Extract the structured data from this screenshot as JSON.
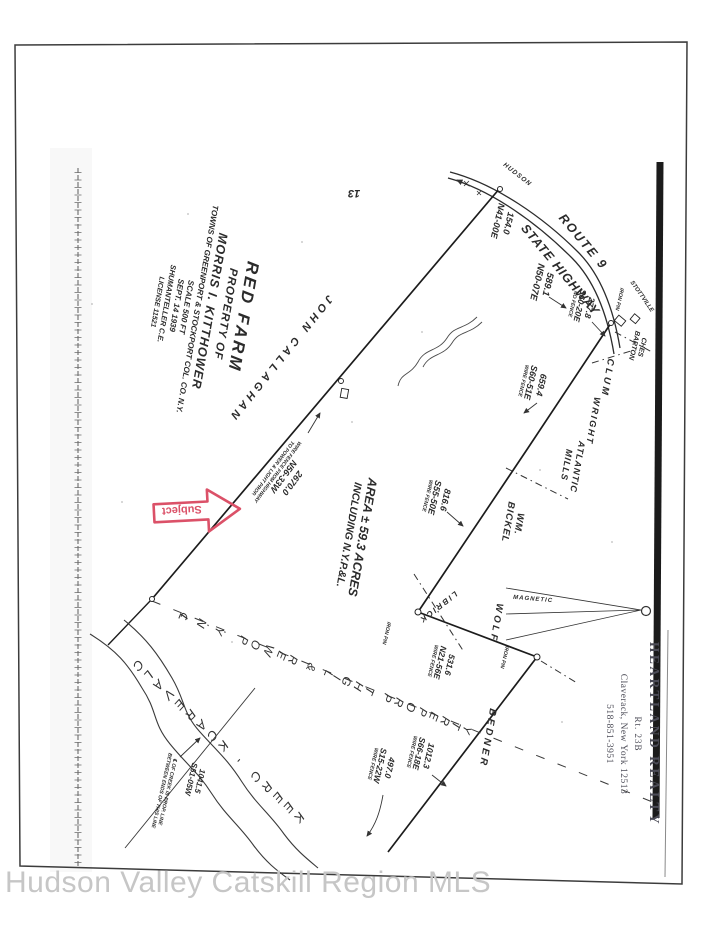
{
  "colors": {
    "ink": "#2b2b2b",
    "stamp_red": "#db5168",
    "watermark_gray": "#c6c6c6"
  },
  "watermark": "Hudson Valley Catskill Region MLS",
  "sheet_number": "13",
  "title_block": {
    "line1": "RED FARM",
    "line2": "PROPERTY OF",
    "line3": "MORRIS I. KITTHOWER",
    "line4": "TOWNS OF GREENPORT & STOCKPORT COL. CO. N.Y.",
    "line5": "SCALE 500 FT",
    "line6": "SEPT. 14 1939",
    "line7": "SHUMANTELLER C.E.",
    "line8": "LICENSE 11521"
  },
  "road": {
    "name1": "ROUTE 9",
    "name2": "STATE HIGHWAY",
    "dir_north": "HUDSON",
    "dir_south": "STOTTVILLE"
  },
  "area": {
    "line1": "AREA ± 59.3 ACRES",
    "line2": "INCLUDING N.Y.P.&L."
  },
  "neighbors": {
    "callaghan": "JOHN CALLAGHAN",
    "ches_barton1": "CHES",
    "ches_barton2": "BARTON",
    "clum": "CLUM",
    "wright": "WRIGHT",
    "atlantic1": "ATLANTIC",
    "atlantic2": "MILLS",
    "bickel1": "WM.",
    "bickel2": "BICKEL",
    "wolf": "WOLF",
    "librick": "LIBRICK",
    "bedner": "BEDNER"
  },
  "bearings": {
    "b154": {
      "dist": "154.0",
      "bear": "N41-00E"
    },
    "b589": {
      "dist": "589.1",
      "bear": "N50-07E"
    },
    "b277": {
      "dist": "277.8",
      "bear": "S60-20E",
      "note": "NO FENCE"
    },
    "b659": {
      "dist": "659.4",
      "bear": "S60-51E",
      "note": "WIRE FENCE"
    },
    "b816": {
      "dist": "816.6",
      "bear": "S55-50E",
      "note": "WIRE FENCE"
    },
    "b2670": {
      "dist": "2670.0",
      "bear": "N56-33W",
      "note1": "WIRE FENCE FROM HIGHWAY",
      "note2": "TO POWER & LIGHT PROP."
    },
    "b531": {
      "dist": "531.6",
      "bear": "N21-56E",
      "note": "WIRE FENCE"
    },
    "b1012": {
      "dist": "1012.3",
      "bear": "S66-18E",
      "note": "WIRE FENCE"
    },
    "b497": {
      "dist": "497.0",
      "bear": "S15-22W",
      "note": "WIRE FENCE"
    },
    "b1041": {
      "dist": "1041.5",
      "bear": "S51-05W",
      "note1": "℄ OF CREEK IS PROP. LINE",
      "note2": "BETWEEN ENDS OF THIS LINE"
    }
  },
  "labels": {
    "power_line": "℄  N.Y. POWER & LIGHT PROPERTY",
    "creek": "CLAVERACK - CREEK",
    "magnetic": "MAGNETIC",
    "iron_pin": "IRON PIN"
  },
  "stamps": {
    "subject": "Subject",
    "realty": {
      "line1": "HEARTLAND REALTY",
      "line2": "Rt. 23B",
      "line3": "Claverack, New York 12513",
      "line4": "518-851-3951"
    }
  }
}
